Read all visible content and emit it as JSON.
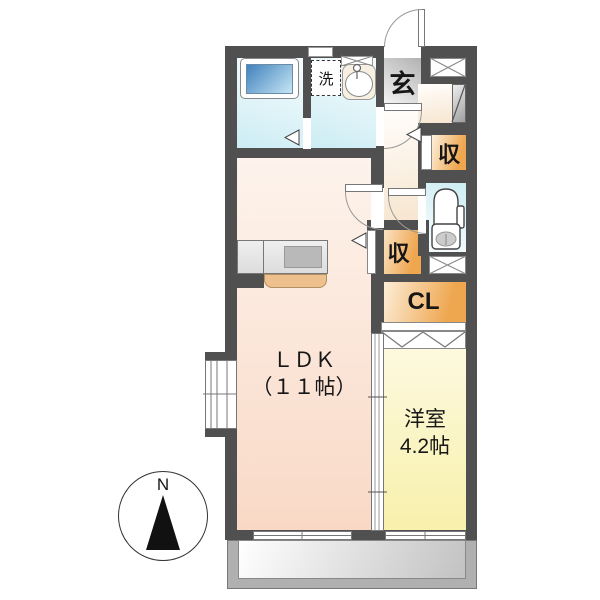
{
  "floorplan": {
    "labels": {
      "laundry": "洗",
      "entrance": "玄",
      "storage_upper": "収",
      "storage_lower": "収",
      "closet": "CL",
      "ldk_name": "ＬＤＫ",
      "ldk_size": "（１１帖）",
      "western_name": "洋室",
      "western_size": "4.2帖",
      "compass_north": "N"
    },
    "colors": {
      "wall": "#505050",
      "water-room": "#cdedf4",
      "water-room-light": "#f3fbfd",
      "hall": "#f7e7d2",
      "hall-light": "#fffdfa",
      "ldk": "#f9d9c6",
      "ldk-light": "#fdf3ec",
      "western": "#f8f0ab",
      "western-light": "#fdfae4",
      "storage": "#eea64f",
      "storage-light": "#fdf0dc",
      "entrance-gray": "#b2b2b2",
      "entrance-gray-light": "#f0f0f0",
      "tub-blue": "#4182bd",
      "tub-blue-light": "#c6e6f5",
      "balcony": "#b0b0b0",
      "counter-tan": "#eec08d"
    }
  }
}
